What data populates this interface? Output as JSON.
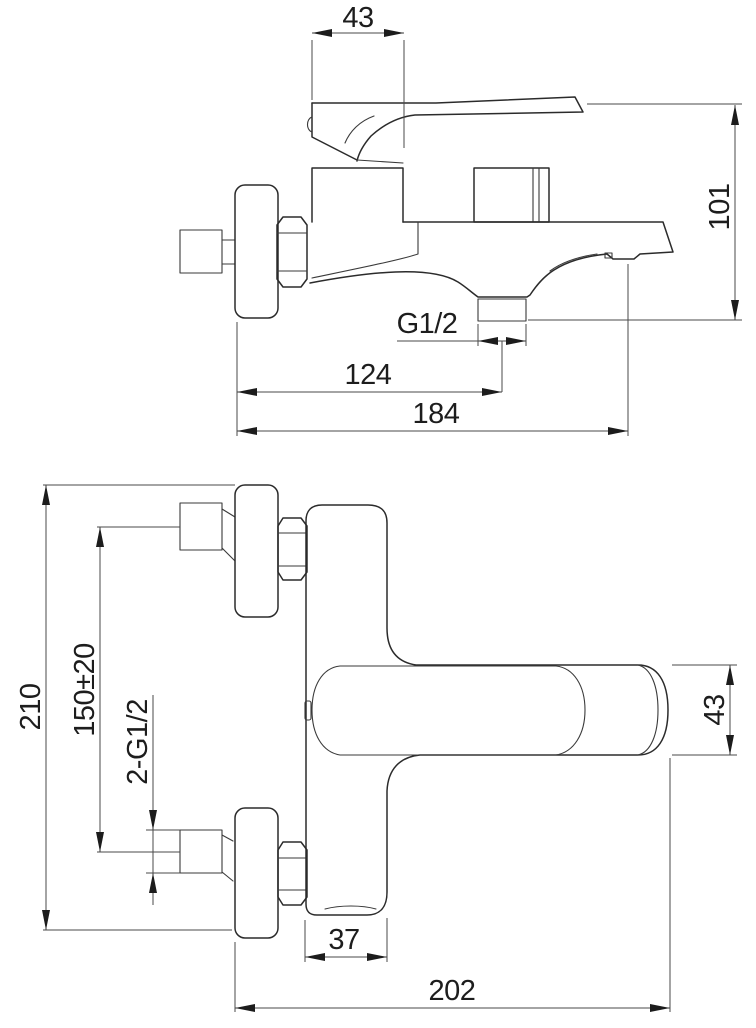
{
  "drawing": {
    "subject": "wall-mounted bath mixer faucet technical drawing, two orthographic views",
    "colors": {
      "background": "#ffffff",
      "object_line": "#2b2b2b",
      "dimension_line": "#4a4a4a",
      "text": "#1d1d1d"
    },
    "dimensions": {
      "side_view": {
        "handle_width": "43",
        "overall_height": "101",
        "shower_outlet_thread": "G1/2",
        "wall_to_outlet": "124",
        "wall_to_spout_tip": "184"
      },
      "front_view": {
        "overall_height": "210",
        "inlet_centers_distance": "150±20",
        "inlet_thread": "2-G1/2",
        "body_height": "43",
        "spout_width": "37",
        "overall_width": "202"
      }
    }
  }
}
